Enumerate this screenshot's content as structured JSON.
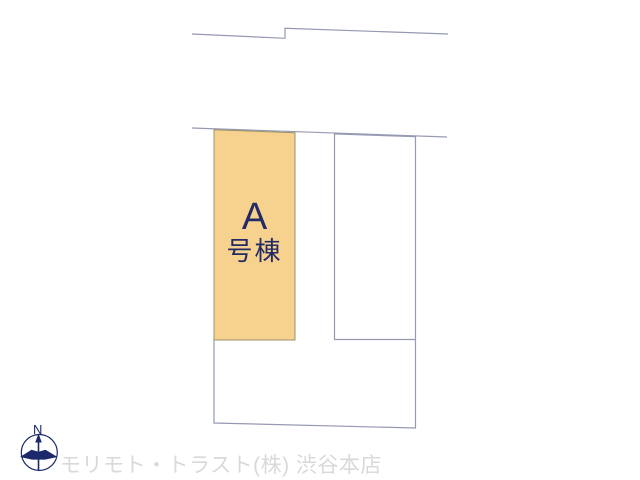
{
  "site_plan": {
    "highlighted_lot": {
      "letter": "A",
      "suffix": "号棟"
    },
    "compass": {
      "north_label": "N"
    },
    "watermark": "モリモト・トラスト(株) 渋谷本店"
  },
  "colors": {
    "lot_fill": "#f7d28e",
    "lot_label_text": "#232a66",
    "boundary_line": "#9599b2",
    "compass": "#1c2a6b",
    "watermark_text": "#d9d9d9"
  }
}
